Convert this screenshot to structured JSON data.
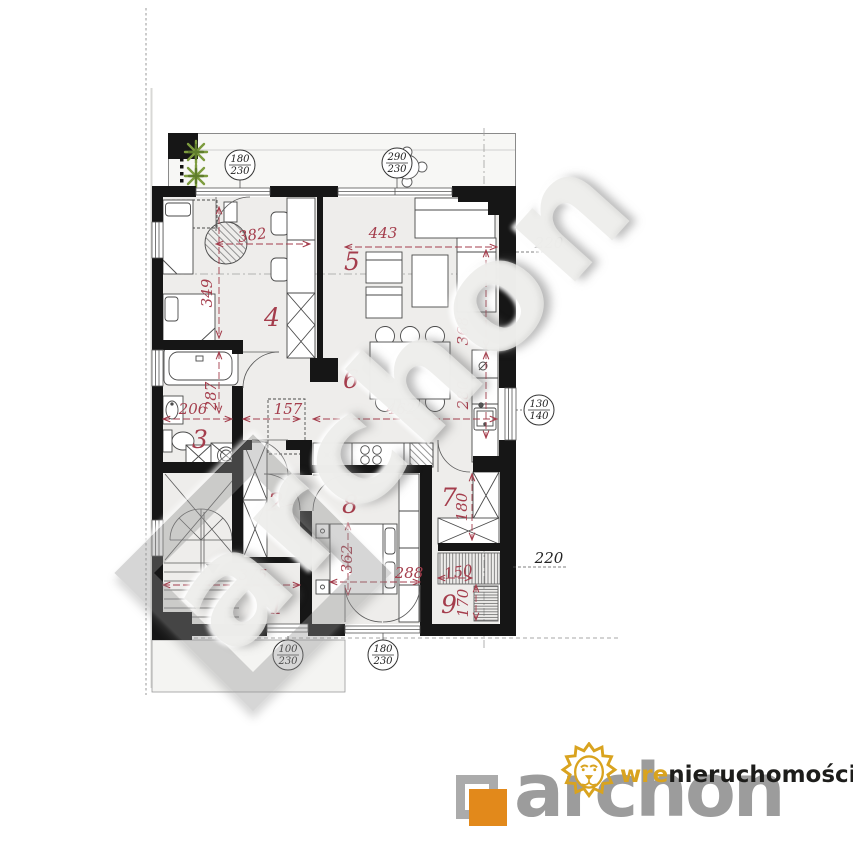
{
  "watermark": {
    "text": "archon"
  },
  "branding": {
    "logo_text": "archon",
    "wre_bold": "wre",
    "wre_rest": "nieruchomości",
    "colors": {
      "logo_gray": "#9c9c9c",
      "logo_orange": "#e2891b",
      "wre_gold": "#d9a31f",
      "text_dark": "#1d1d1b"
    }
  },
  "plan": {
    "accent_red": "#a43d4c",
    "rooms": [
      "1",
      "2",
      "3",
      "4",
      "5",
      "6",
      "7",
      "8",
      "9"
    ],
    "dims": {
      "w382": "382",
      "w443": "443",
      "h349": "349",
      "h287": "287",
      "w206": "206",
      "w157": "157",
      "w462": "462",
      "h368": "368",
      "h280": "280",
      "w375": "375",
      "w288": "288",
      "h362": "362",
      "h180": "180",
      "w150": "150",
      "h170": "170"
    },
    "levels": {
      "right_top": "220",
      "right_bottom": "220"
    },
    "openings": [
      {
        "top": "180",
        "bottom": "230"
      },
      {
        "top": "290",
        "bottom": "230"
      },
      {
        "top": "130",
        "bottom": "140"
      },
      {
        "top": "100",
        "bottom": "230"
      },
      {
        "top": "180",
        "bottom": "230"
      }
    ]
  }
}
